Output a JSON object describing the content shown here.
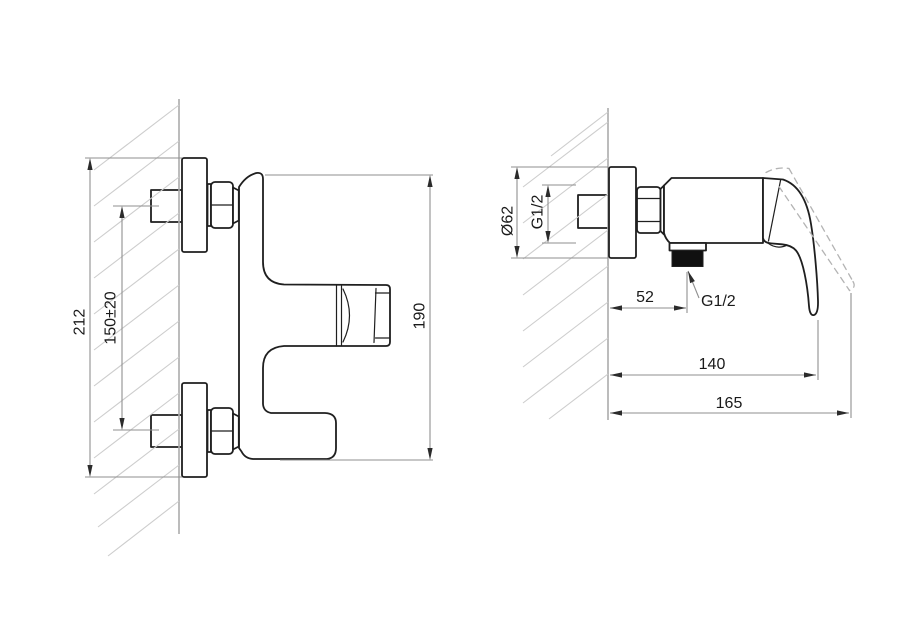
{
  "drawing": {
    "type": "technical-dimension-drawing",
    "views": {
      "front": {
        "dimensions": {
          "overall_height": "212",
          "mounting_centers": "150±20",
          "body_height": "190"
        }
      },
      "side": {
        "dimensions": {
          "escutcheon_diameter": "Ø62",
          "inlet_thread": "G1/2",
          "wall_to_outlet": "52",
          "outlet_thread": "G1/2",
          "wall_to_handle": "140",
          "wall_to_handle_open": "165"
        }
      }
    },
    "colors": {
      "background": "#ffffff",
      "outline": "#1f1f1f",
      "dimension_line": "#8f8f8f",
      "arrow": "#2b2b2b",
      "text": "#1a1a1a",
      "hatch": "#cdcdcd",
      "wall": "#ababab",
      "thread_fill": "#101010",
      "dashed_line": "#b3b3b3"
    }
  }
}
